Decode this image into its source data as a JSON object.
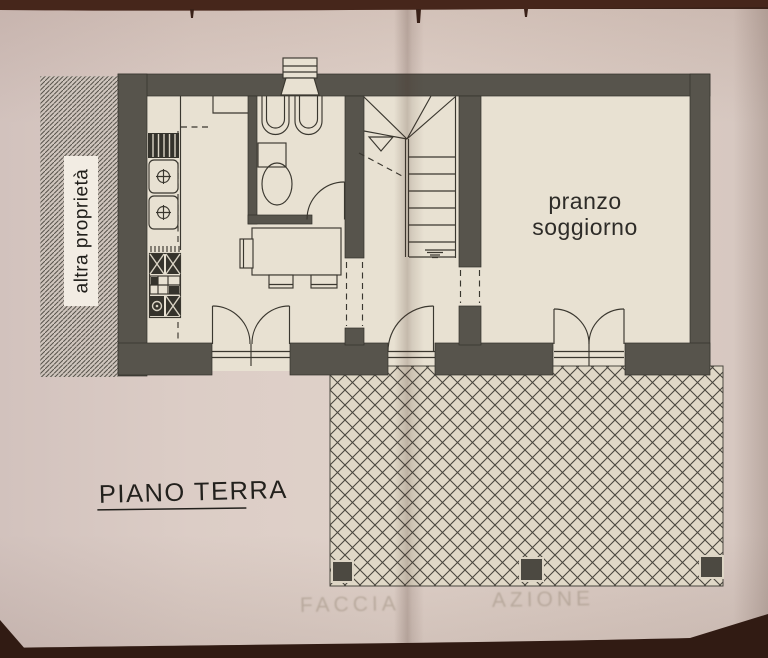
{
  "labels": {
    "floor_title": "PIANO TERRA",
    "adjacent_property": "altra proprietà",
    "living_dining_line1": "pranzo",
    "living_dining_line2": "soggiorno",
    "ghost_left": "FACCIA",
    "ghost_right": "AZIONE"
  },
  "colors": {
    "wall": "#57544c",
    "floor": "#e8e1d2",
    "paper": "#dccdc6",
    "table_bg": "#3a2118",
    "terrace_bg": "#e0d8c7",
    "hatch_bg": "#cfc5bd",
    "ink": "#3a372f",
    "label_bg": "#f2ece3",
    "ghost": "#8a7a66"
  }
}
